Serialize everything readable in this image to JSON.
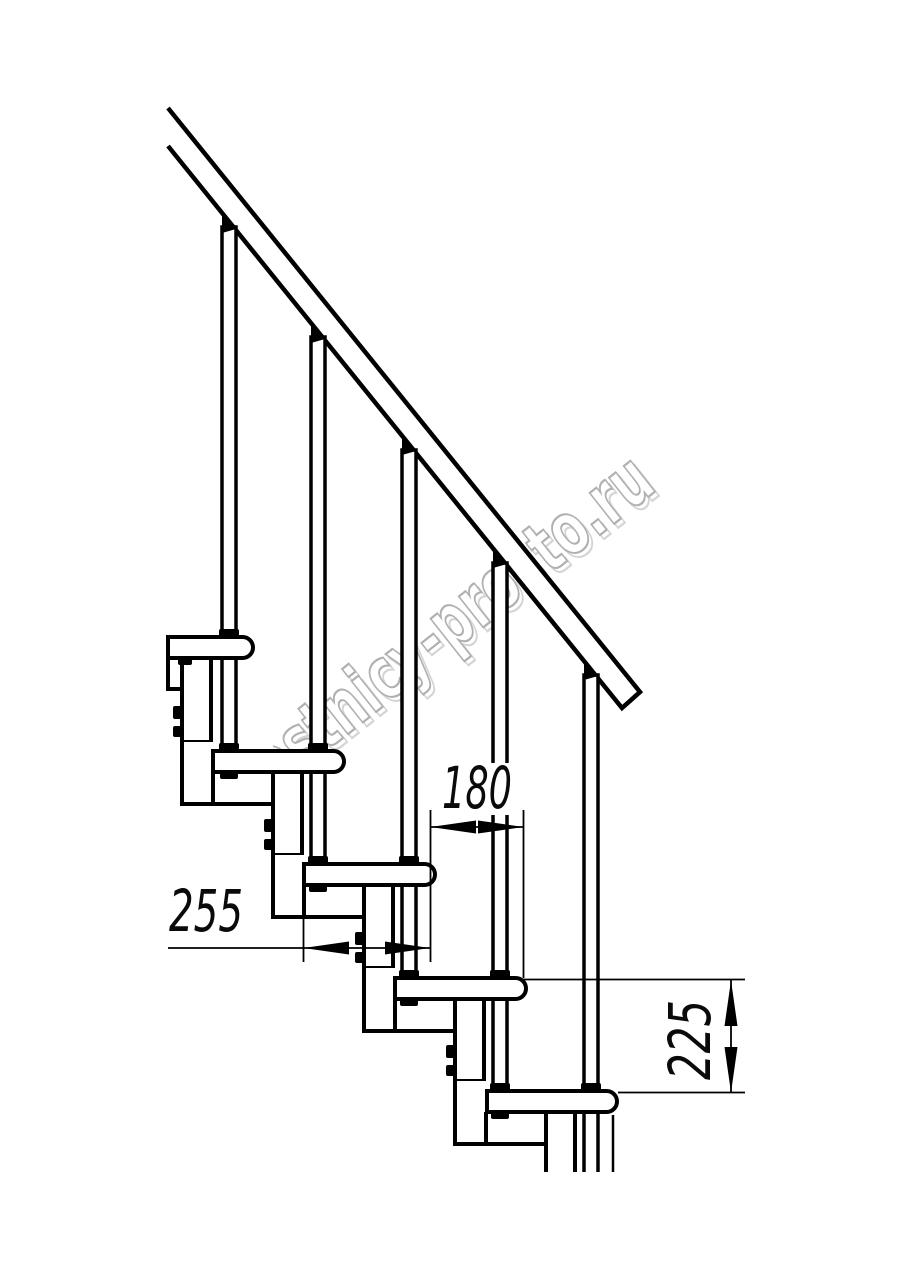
{
  "watermark": {
    "text": "lestnicy-prosto.ru"
  },
  "dimensions": {
    "tread_depth": {
      "value": "255"
    },
    "step_run": {
      "value": "180"
    },
    "step_rise": {
      "value": "225"
    }
  }
}
